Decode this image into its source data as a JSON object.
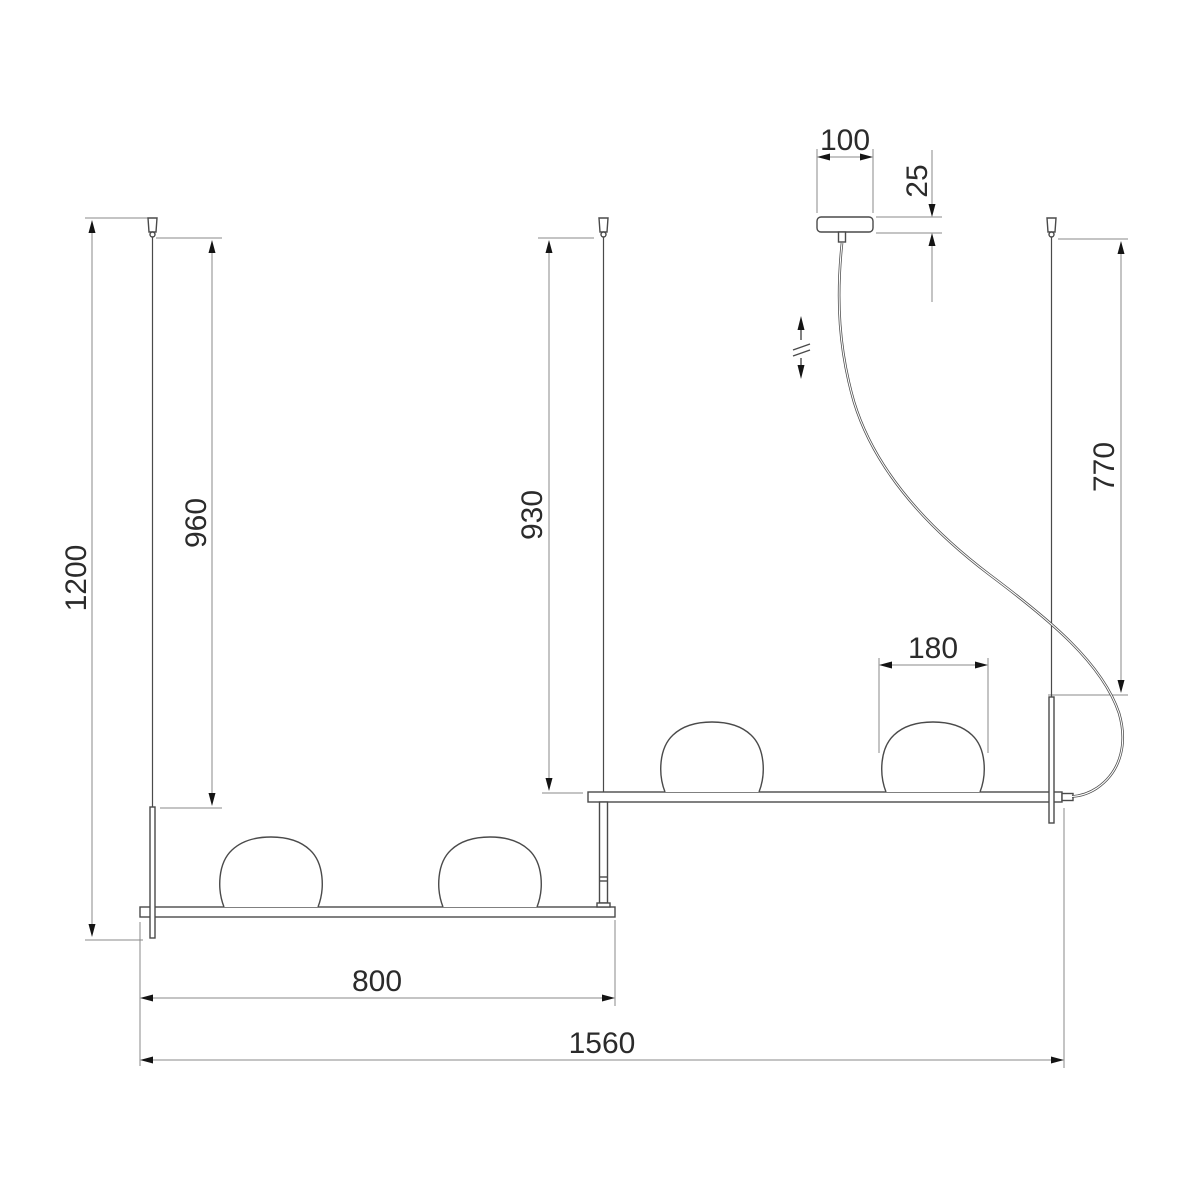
{
  "drawing": {
    "dims": {
      "overall_drop": "1200",
      "left_suspension": "960",
      "middle_suspension": "930",
      "right_suspension": "770",
      "canopy_width": "100",
      "canopy_height": "25",
      "shade_diameter": "180",
      "lower_bar_length": "800",
      "overall_width": "1560"
    },
    "colors": {
      "background": "#ffffff",
      "outline": "#4a4a4a",
      "dimension_line": "#8a8a8a",
      "arrow": "#141414",
      "text": "#2b2b2b"
    }
  }
}
